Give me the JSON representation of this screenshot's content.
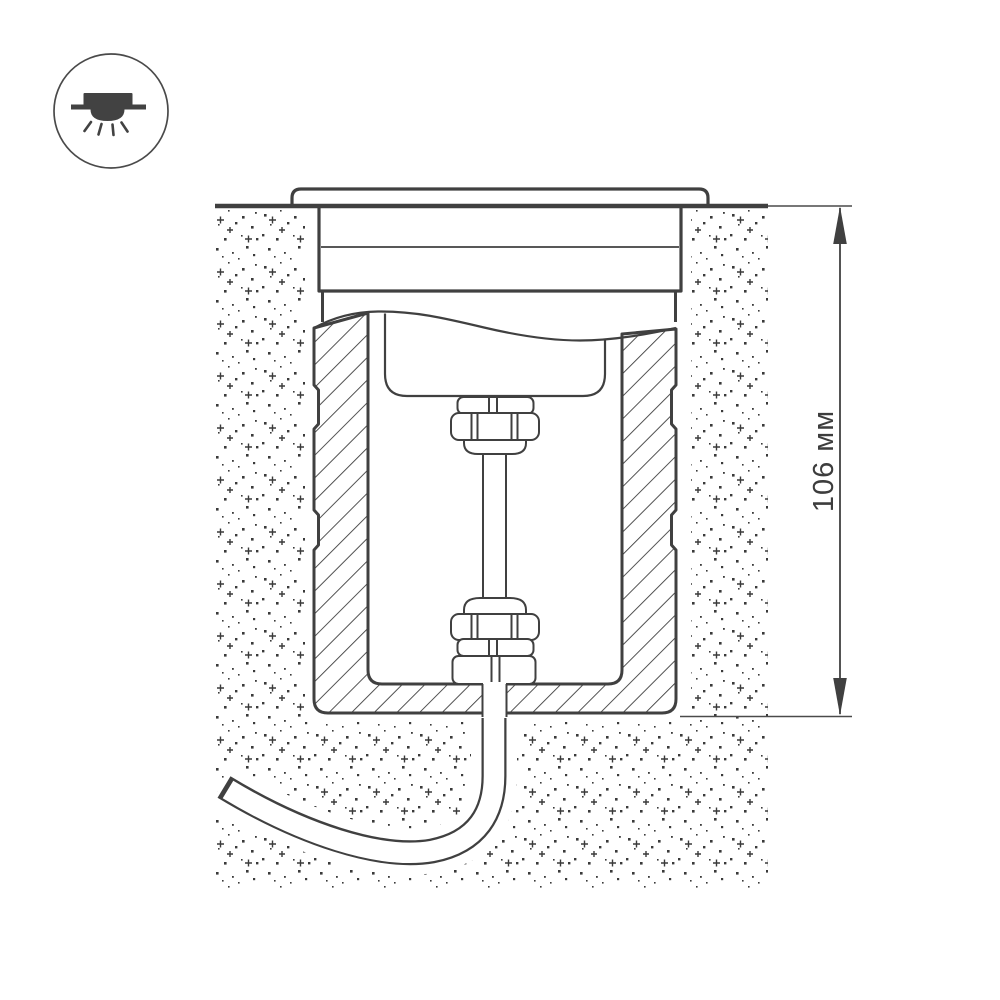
{
  "diagram": {
    "title_present": false,
    "dimension_label": "106 мм",
    "dimension_value": "106",
    "dimension_unit": "мм"
  },
  "icon": {
    "name": "recessed-downlight-icon"
  },
  "colors": {
    "line": "#404040",
    "line_light": "#4a4a4a",
    "stipple": "#3a3a3a",
    "background": "#ffffff"
  }
}
